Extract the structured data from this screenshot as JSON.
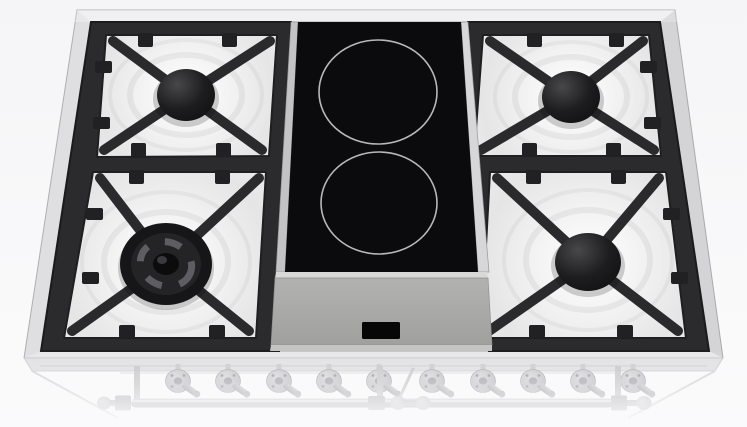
{
  "scene": {
    "object": "Dual-fuel 90cm range cooktop, 3D product render, top perspective view",
    "description": "Stainless cooktop with four gas burners on black cast-iron grates over white enamel wells, central black induction glass with two zones, ghosted front control knobs and towel-bar handle fading to white"
  },
  "cooktop": {
    "gas_burners": [
      {
        "id": "rear-left",
        "type": "standard-cap"
      },
      {
        "id": "front-left",
        "type": "triple-ring-wok"
      },
      {
        "id": "rear-right",
        "type": "standard-cap"
      },
      {
        "id": "front-right",
        "type": "standard-cap"
      }
    ],
    "grates": "black cast iron, X-arm pot supports",
    "induction": {
      "zones": 2,
      "surface": "black ceramic glass",
      "zone_marking": "thin light ring"
    },
    "control_panel": {
      "display": "blank black display window",
      "labels": []
    },
    "knobs": {
      "count": 10,
      "style": "metal lever knobs, ghosted"
    },
    "handle": {
      "style": "front rail with ball finials and brackets",
      "ghosted": true
    }
  },
  "colors": {
    "background": "#f6f6f8",
    "rim": "#e7e7e9",
    "rim_edge": "#b2b2b4",
    "grate": "#2b2b2d",
    "grate_dark": "#1b1b1d",
    "enamel": "#f0f0f1",
    "burner_cap": "#141415",
    "glass": "#0b0b0d",
    "zone_ring": "#c8c8ca",
    "steel_trim_left": "#c3c3c5",
    "steel_trim_right": "#d7d7d9",
    "panel": "#a8a8a6",
    "display": "#070708",
    "ghost_metal": "#c4c4c8"
  }
}
